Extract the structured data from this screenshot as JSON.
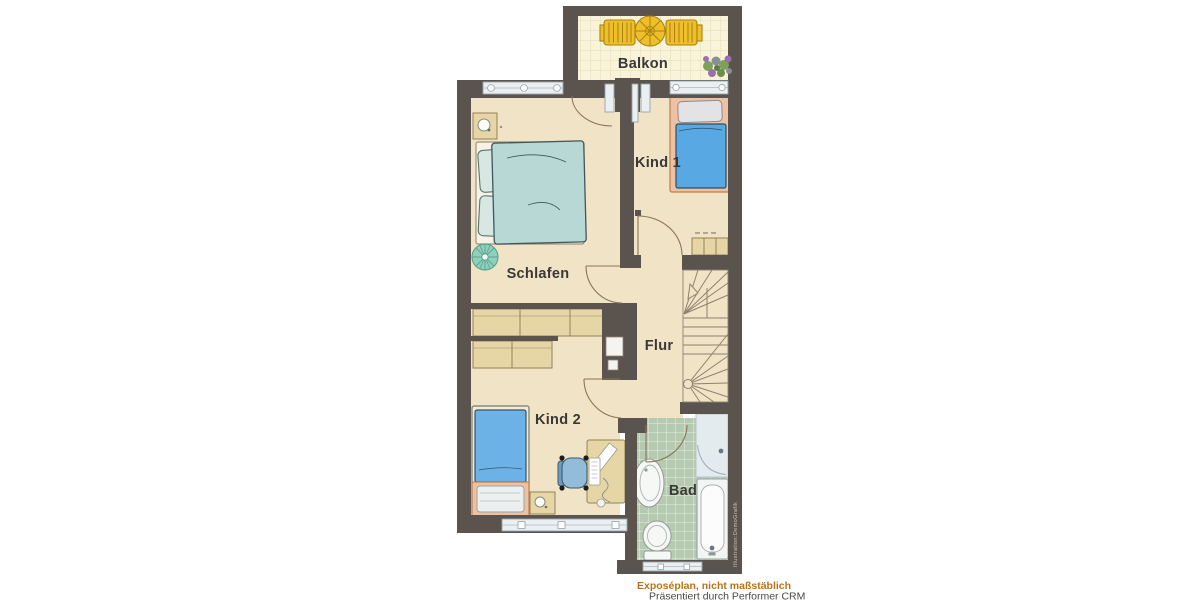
{
  "rooms": {
    "balkon": "Balkon",
    "kind1": "Kind 1",
    "schlafen": "Schlafen",
    "flur": "Flur",
    "kind2": "Kind 2",
    "bad": "Bad"
  },
  "captions": {
    "line1": "Exposéplan, nicht maßstäblich",
    "line2": "Präsentiert durch Performer CRM"
  },
  "watermark": "Illustration:DemoGrafik",
  "colors": {
    "wall": "#5b534d",
    "floor": "#f1e3c6",
    "balconyTile": "#f8f3d9",
    "balconyTileLine": "#e5ddb6",
    "badTile": "#b6cab1",
    "badTileLine": "#e7eee4",
    "windowGlass": "#eaeff2",
    "furnitureTan": "#e7d6a5",
    "bedTeal": "#b7d8d4",
    "bedBlueKind1": "#58a9e3",
    "bedBlueKind2": "#6cb2e6",
    "salmon": "#eec2a0",
    "balconyYellow": "#eebf2a",
    "rugGreen": "#8fd0bd",
    "chairBlue": "#93bcdb",
    "doorArc": "#8a7558",
    "stairLine": "#8d8270",
    "label": "#3a3836",
    "captionOrange": "#b5731e",
    "captionGray": "#4b4946"
  }
}
